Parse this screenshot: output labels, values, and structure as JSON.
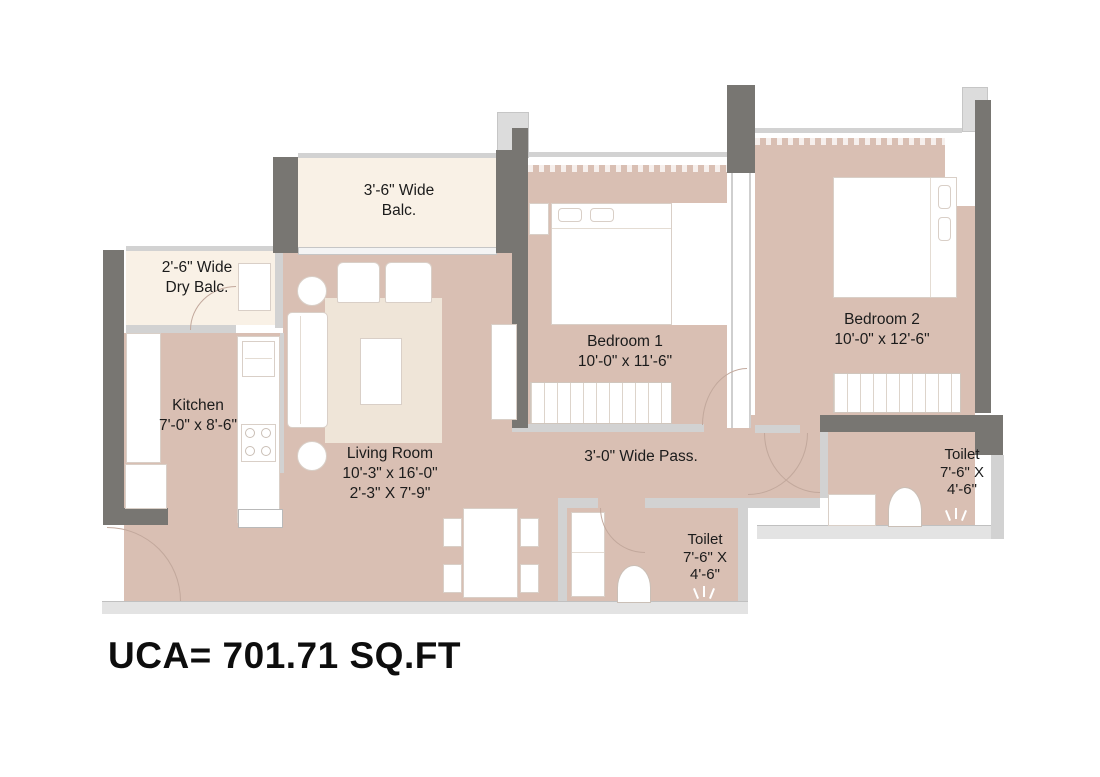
{
  "plan": {
    "area_note": "UCA= 701.71 SQ.FT",
    "rooms": {
      "balcony": {
        "lines": [
          "3'-6\" Wide",
          "Balc."
        ]
      },
      "dry_balcony": {
        "lines": [
          "2'-6\" Wide",
          "Dry Balc."
        ]
      },
      "kitchen": {
        "lines": [
          "Kitchen",
          "7'-0\" x 8'-6\""
        ]
      },
      "living_room": {
        "lines": [
          "Living Room",
          "10'-3\" x 16'-0\"",
          "2'-3\" X 7'-9\""
        ]
      },
      "bedroom_1": {
        "lines": [
          "Bedroom 1",
          "10'-0\" x 11'-6\""
        ]
      },
      "bedroom_2": {
        "lines": [
          "Bedroom 2",
          "10'-0\" x 12'-6\""
        ]
      },
      "passage": {
        "lines": [
          "3'-0\" Wide Pass."
        ]
      },
      "toilet_1": {
        "lines": [
          "Toilet",
          "7'-6\" X",
          "4'-6\""
        ]
      },
      "toilet_2": {
        "lines": [
          "Toilet",
          "7'-6\" X",
          "4'-6\""
        ]
      }
    },
    "colors": {
      "floor": "#d9bfb3",
      "balcony": "#f9f1e6",
      "wall_dark": "#787672",
      "wall_light": "#d2d2d2",
      "rug": "#efe5d8",
      "text": "#1b1b1b"
    }
  }
}
